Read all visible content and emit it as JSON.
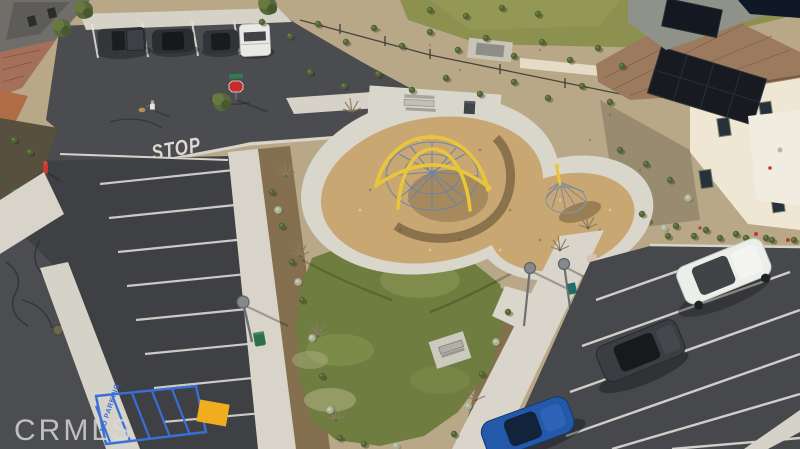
{
  "image": {
    "kind": "aerial-drone-photo",
    "subject": "Aerial view of a neighborhood pocket park with playground, lawn, street and two parking lots",
    "watermark": "CRMLS"
  },
  "road_markings": {
    "stop": "STOP",
    "no_parking": "NO PARKING"
  },
  "palette": {
    "asphalt": "#46484c",
    "asphalt_dark": "#3e4043",
    "concrete": "#d8d4ca",
    "grass": "#6f7d40",
    "grass_light": "#93a058",
    "wood_chips": "#c9a772",
    "desert_ground": "#b9a888",
    "hillside": "#8d9150",
    "mulch": "#84704f",
    "shrub_green": "#4e6233",
    "sage_green": "#aeb49b",
    "roof_tile": "#9b7a5e",
    "house_wall": "#efe6d4",
    "solar_panel": "#191d23",
    "stall_line_white": "#dedbd4",
    "handicap_blue": "#3a6fd8",
    "ada_pad_yellow": "#f0ad1d",
    "stop_sign_red": "#c52c2c",
    "suv_white": "#eceeea",
    "suv_dark": "#3a3e42",
    "car_blue": "#2458a8",
    "climber_yellow": "#e9c639",
    "net_blue": "#6b83ad"
  },
  "scene": {
    "vehicles": [
      {
        "name": "dark pickup truck",
        "location": "top street parking"
      },
      {
        "name": "dark sedan",
        "location": "top street parking"
      },
      {
        "name": "dark SUV",
        "location": "top street parking"
      },
      {
        "name": "white pickup",
        "location": "top street parking"
      },
      {
        "name": "white SUV",
        "location": "right parking lot"
      },
      {
        "name": "dark gray SUV",
        "location": "right parking lot"
      },
      {
        "name": "blue car",
        "location": "right parking lot bottom"
      }
    ],
    "park_features": [
      "yellow dome rope climber with blue netting",
      "cone rope climber",
      "wood chip play surface",
      "looping concrete path",
      "benches",
      "trash receptacles",
      "lawn",
      "young trees",
      "street lamps",
      "drought-tolerant landscaping"
    ],
    "street_features": [
      "STOP pavement marking",
      "stop sign with street-name blade",
      "blue striped no-parking zone",
      "yellow ADA ramp pad",
      "fire hydrant",
      "green utility box",
      "manhole cover"
    ],
    "people": [
      "pedestrian walking a small dog"
    ],
    "buildings": [
      "two-story cream house with tile roof and rooftop solar panels (right)",
      "residences with tile roofs (left edge)"
    ]
  }
}
